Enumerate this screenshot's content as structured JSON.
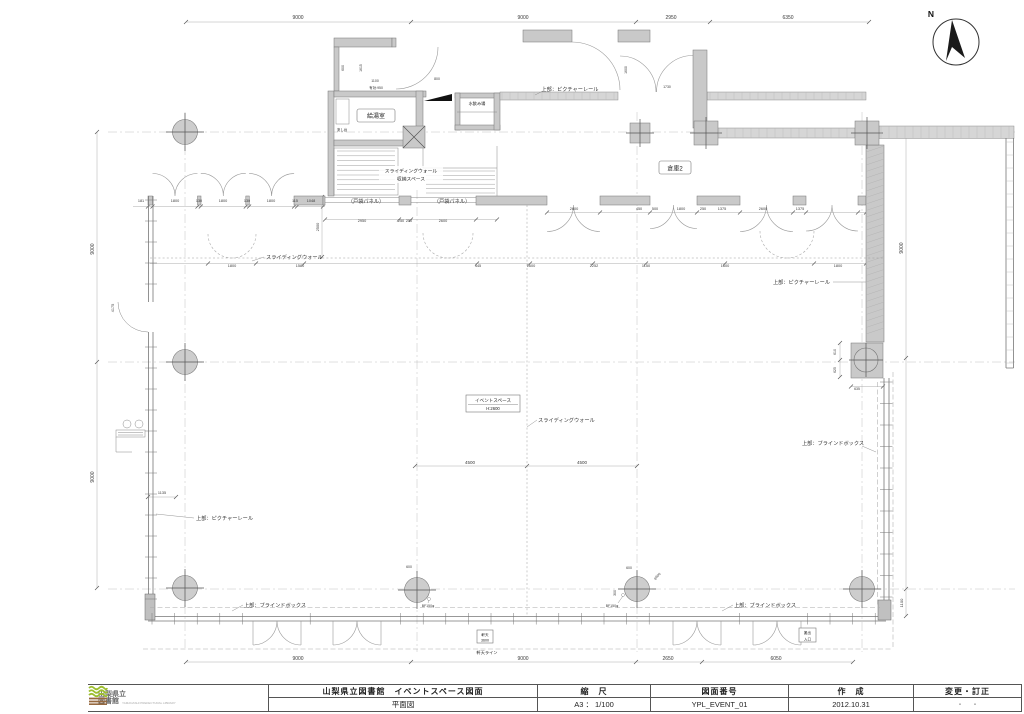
{
  "compass": {
    "label": "N"
  },
  "title_block": {
    "logo_line1": "山梨県立",
    "logo_line2": "図書館",
    "logo_sub": "YAMANASHI PREFECTURAL LIBRARY",
    "project": "山梨県立図書館　イベントスペース図面",
    "sheet_name": "平面図",
    "scale_label": "縮　尺",
    "scale_value": "A3 ： 1/100",
    "drawing_no_label": "図面番号",
    "drawing_no_value": "YPL_EVENT_01",
    "created_label": "作　成",
    "created_value": "2012.10.31",
    "revision_label": "変更・訂正",
    "revision_value": "・　・"
  },
  "rooms": {
    "event_space_name": "イベントスペース",
    "event_space_height": "H:2600",
    "kitchenette": "給湯室",
    "sink": "流し台",
    "drinking_fountain": "水飲み場",
    "storage2": "倉庫2",
    "sliding_storage_line1": "スライディングウォール",
    "sliding_storage_line2": "収納スペース",
    "eave_label_line1": "軒天",
    "eave_label_line2": "3600",
    "eave_line": "軒天ライン",
    "loading_line1": "搬出",
    "loading_line2": "入口"
  },
  "annotations": [
    {
      "t": "上部：ピクチャーレール",
      "x": 570,
      "y": 91,
      "a": "middle"
    },
    {
      "t": "上部：ピクチャーレール",
      "x": 830,
      "y": 284,
      "a": "end"
    },
    {
      "t": "上部：ピクチャーレール",
      "x": 196,
      "y": 520,
      "a": "start"
    },
    {
      "t": "上部：ブラインドボックス",
      "x": 275,
      "y": 607,
      "a": "middle"
    },
    {
      "t": "上部：ブラインドボックス",
      "x": 765,
      "y": 607,
      "a": "middle"
    },
    {
      "t": "上部：ブラインドボックス",
      "x": 833,
      "y": 445,
      "a": "middle"
    },
    {
      "t": "スライディングウォール",
      "x": 266,
      "y": 259,
      "a": "start"
    },
    {
      "t": "スライディングウォール",
      "x": 538,
      "y": 422,
      "a": "start"
    },
    {
      "t": "（戸袋パネル）",
      "x": 366,
      "y": 203,
      "a": "middle"
    },
    {
      "t": "（戸袋パネル）",
      "x": 452,
      "y": 203,
      "a": "middle"
    }
  ],
  "dimensions": [
    {
      "v": "9000",
      "x": 298,
      "y": 19,
      "s": 5
    },
    {
      "v": "9000",
      "x": 523,
      "y": 19,
      "s": 5
    },
    {
      "v": "2950",
      "x": 671,
      "y": 19,
      "s": 5
    },
    {
      "v": "6350",
      "x": 788,
      "y": 19,
      "s": 5
    },
    {
      "v": "9000",
      "x": 298,
      "y": 660,
      "s": 5
    },
    {
      "v": "9000",
      "x": 523,
      "y": 660,
      "s": 5
    },
    {
      "v": "2650",
      "x": 668,
      "y": 660,
      "s": 5
    },
    {
      "v": "6050",
      "x": 776,
      "y": 660,
      "s": 5
    },
    {
      "v": "9000",
      "x": 94,
      "y": 249,
      "r": -90,
      "s": 5
    },
    {
      "v": "9000",
      "x": 94,
      "y": 477,
      "r": -90,
      "s": 5
    },
    {
      "v": "9000",
      "x": 903,
      "y": 248,
      "r": -90,
      "s": 5
    },
    {
      "v": "1100",
      "x": 903,
      "y": 603,
      "r": -90,
      "s": 4
    },
    {
      "v": "181",
      "x": 141,
      "y": 202
    },
    {
      "v": "1800",
      "x": 175,
      "y": 202
    },
    {
      "v": "130",
      "x": 199,
      "y": 202
    },
    {
      "v": "1800",
      "x": 223,
      "y": 202
    },
    {
      "v": "130",
      "x": 247,
      "y": 202
    },
    {
      "v": "1800",
      "x": 271,
      "y": 202
    },
    {
      "v": "115",
      "x": 295,
      "y": 202
    },
    {
      "v": "1048",
      "x": 311,
      "y": 202
    },
    {
      "v": "2500",
      "x": 319,
      "y": 227,
      "r": -90
    },
    {
      "v": "2950",
      "x": 362,
      "y": 222
    },
    {
      "v": "250",
      "x": 401,
      "y": 222
    },
    {
      "v": "250",
      "x": 409,
      "y": 222
    },
    {
      "v": "2600",
      "x": 443,
      "y": 222
    },
    {
      "v": "2600",
      "x": 574,
      "y": 210
    },
    {
      "v": "450",
      "x": 639,
      "y": 210
    },
    {
      "v": "500",
      "x": 655,
      "y": 210
    },
    {
      "v": "1800",
      "x": 681,
      "y": 210
    },
    {
      "v": "250",
      "x": 703,
      "y": 210
    },
    {
      "v": "1375",
      "x": 722,
      "y": 210
    },
    {
      "v": "2600",
      "x": 763,
      "y": 210
    },
    {
      "v": "1375",
      "x": 800,
      "y": 210
    },
    {
      "v": "1800",
      "x": 232,
      "y": 267
    },
    {
      "v": "1580",
      "x": 300,
      "y": 267
    },
    {
      "v": "445",
      "x": 478,
      "y": 267
    },
    {
      "v": "1600",
      "x": 531,
      "y": 267
    },
    {
      "v": "2252",
      "x": 594,
      "y": 267
    },
    {
      "v": "1150",
      "x": 646,
      "y": 267
    },
    {
      "v": "1600",
      "x": 725,
      "y": 267
    },
    {
      "v": "1800",
      "x": 838,
      "y": 267
    },
    {
      "v": "4500",
      "x": 470,
      "y": 464,
      "s": 4.5
    },
    {
      "v": "4500",
      "x": 582,
      "y": 464,
      "s": 4.5
    },
    {
      "v": "1135",
      "x": 162,
      "y": 494
    },
    {
      "v": "4175",
      "x": 114,
      "y": 308,
      "r": -90
    },
    {
      "v": "600",
      "x": 344,
      "y": 68,
      "r": -90,
      "s": 3.5
    },
    {
      "v": "1615",
      "x": 362,
      "y": 68,
      "r": -90,
      "s": 3.5
    },
    {
      "v": "1100",
      "x": 375,
      "y": 82,
      "s": 3.5
    },
    {
      "v": "有効:950",
      "x": 376,
      "y": 89,
      "s": 3.5
    },
    {
      "v": "800",
      "x": 437,
      "y": 80,
      "s": 3.5
    },
    {
      "v": "1600",
      "x": 627,
      "y": 70,
      "r": -90,
      "s": 3.5
    },
    {
      "v": "1730",
      "x": 667,
      "y": 88,
      "s": 3.5
    },
    {
      "v": "610",
      "x": 836,
      "y": 352,
      "r": -90,
      "s": 3.5
    },
    {
      "v": "625",
      "x": 836,
      "y": 370,
      "r": -90,
      "s": 3.5
    },
    {
      "v": "635",
      "x": 857,
      "y": 390,
      "s": 3.5
    },
    {
      "v": "600",
      "x": 409,
      "y": 568,
      "s": 3.5
    },
    {
      "v": "BF150φ",
      "x": 428,
      "y": 607,
      "s": 3.5
    },
    {
      "v": "600",
      "x": 629,
      "y": 569,
      "s": 3.5
    },
    {
      "v": "300",
      "x": 616,
      "y": 593,
      "r": -90,
      "s": 3.5
    },
    {
      "v": "BF150φ",
      "x": 612,
      "y": 607,
      "s": 3.5
    },
    {
      "v": "φ600",
      "x": 658,
      "y": 577,
      "r": -45,
      "s": 3.5
    }
  ]
}
